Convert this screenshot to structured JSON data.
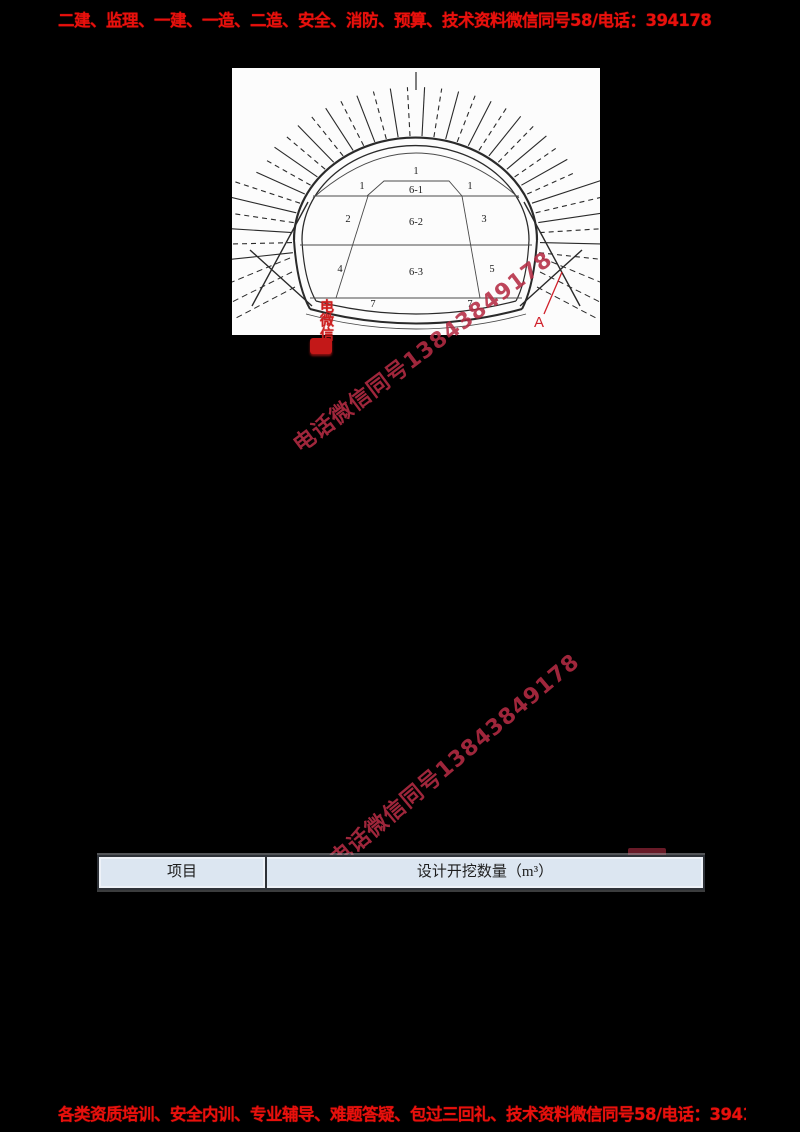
{
  "banners": {
    "top": "二建、监理、一建、一造、二造、安全、消防、预算、技术资料微信同号58/电话：394178",
    "bottom": "各类资质培训、安全内训、专业辅导、难题答疑、包过三回礼、技术资料微信同号58/电话：394178"
  },
  "watermarks": {
    "diagonal_1": "电话微信同号13843849178",
    "diagonal_2": "电话微信同号13843849178",
    "stamp": "电微信"
  },
  "diagram": {
    "sections": {
      "crown": "1",
      "upper_left": "1",
      "core_top": "6-1",
      "upper_right": "1",
      "mid_left": "2",
      "core_mid": "6-2",
      "mid_right": "3",
      "low_left": "4",
      "core_low": "6-3",
      "low_right": "5",
      "invert_left": "7",
      "invert_right": "7"
    },
    "marker": "A"
  },
  "table": {
    "headers": [
      "项目",
      "设计开挖数量（m³）"
    ]
  },
  "colors": {
    "banner_red": "#e8100c",
    "watermark_red": "#b52c44",
    "stamp_red": "#cc1f1f",
    "table_header_bg": "#dce6f1",
    "page_bg": "#000000"
  }
}
